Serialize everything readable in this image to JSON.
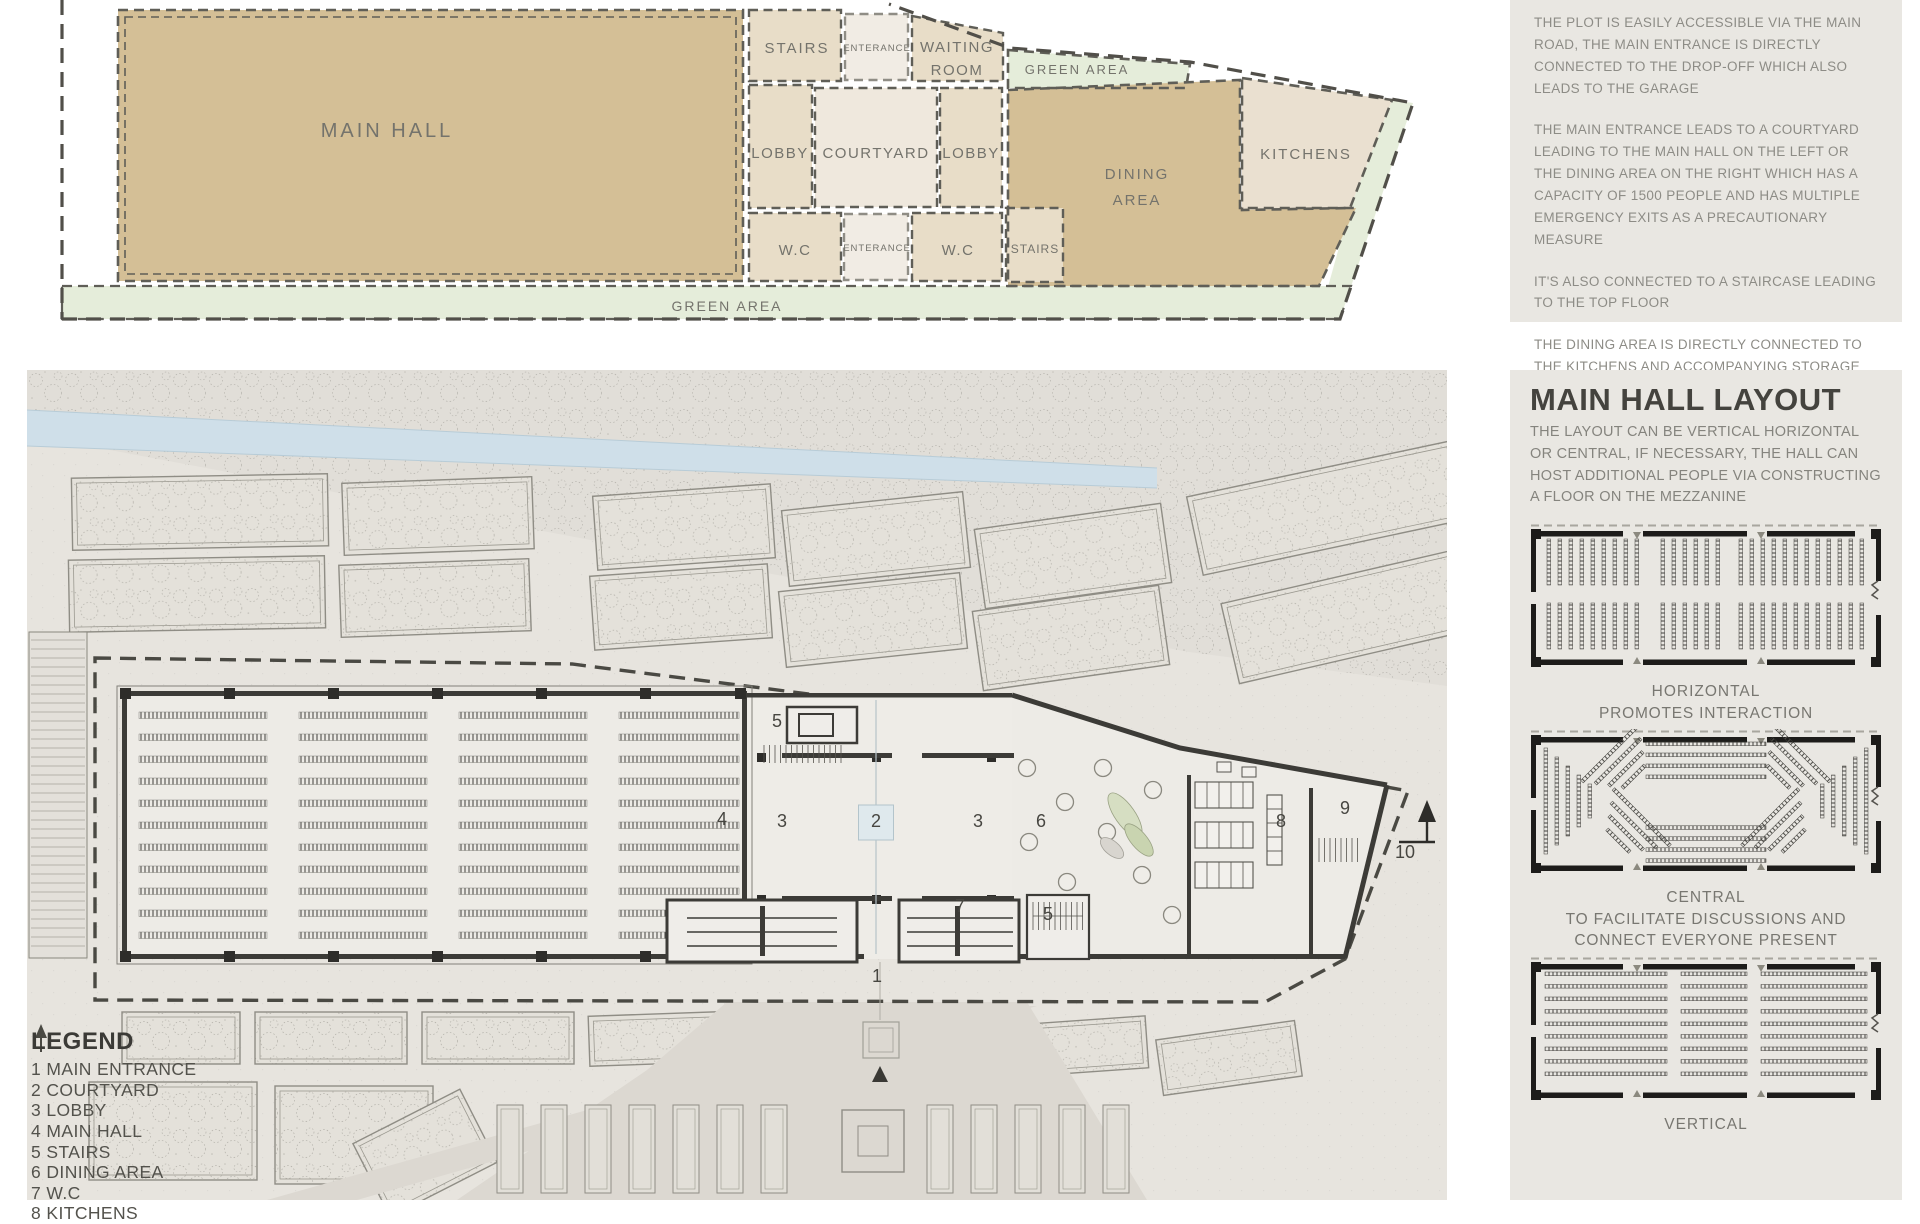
{
  "board": {
    "zoning": {
      "labels": {
        "main_hall": "MAIN HALL",
        "stairs": "STAIRS",
        "enterance": "ENTERANCE",
        "waiting_room": [
          "WAITING",
          "ROOM"
        ],
        "green_area": "GREEN AREA",
        "lobby": "LOBBY",
        "courtyard": "COURTYARD",
        "dining_area": [
          "DINING",
          "AREA"
        ],
        "kitchens": "KITCHENS",
        "wc": "W.C"
      }
    },
    "circulation_notes": {
      "paragraphs": [
        "THE PLOT IS EASILY ACCESSIBLE VIA THE MAIN ROAD, THE MAIN ENTRANCE IS DIRECTLY CONNECTED TO THE DROP-OFF WHICH ALSO LEADS TO THE GARAGE",
        "THE MAIN ENTRANCE LEADS TO A COURTYARD LEADING TO THE MAIN HALL ON THE LEFT OR THE DINING AREA ON THE RIGHT WHICH HAS A CAPACITY OF 1500 PEOPLE AND HAS MULTIPLE EMERGENCY EXITS AS A PRECAUTIONARY MEASURE",
        "IT'S ALSO CONNECTED TO A STAIRCASE LEADING TO THE TOP FLOOR",
        "THE DINING AREA IS DIRECTLY CONNECTED TO THE KITCHENS AND ACCOMPANYING STORAGE ROOMS IN ADDITION TO A STAIRCASE LEADING TO THE DINING AREA ON THE TOP FLOOR"
      ]
    },
    "site_plan": {
      "legend": {
        "title": "LEGEND",
        "items": [
          {
            "num": "1",
            "label": "MAIN ENTRANCE"
          },
          {
            "num": "2",
            "label": "COURTYARD"
          },
          {
            "num": "3",
            "label": "LOBBY"
          },
          {
            "num": "4",
            "label": "MAIN HALL"
          },
          {
            "num": "5",
            "label": "STAIRS"
          },
          {
            "num": "6",
            "label": "DINING AREA"
          },
          {
            "num": "7",
            "label": "W.C"
          },
          {
            "num": "8",
            "label": "KITCHENS"
          }
        ]
      },
      "markers": [
        {
          "label": "5",
          "x": 750,
          "y": 357
        },
        {
          "label": "4",
          "x": 695,
          "y": 455
        },
        {
          "label": "3",
          "x": 755,
          "y": 457
        },
        {
          "label": "2",
          "x": 849,
          "y": 457,
          "boxed": true
        },
        {
          "label": "3",
          "x": 951,
          "y": 457
        },
        {
          "label": "6",
          "x": 1014,
          "y": 457
        },
        {
          "label": "7",
          "x": 933,
          "y": 542
        },
        {
          "label": "5",
          "x": 1021,
          "y": 550
        },
        {
          "label": "1",
          "x": 850,
          "y": 612
        },
        {
          "label": "8",
          "x": 1254,
          "y": 457
        },
        {
          "label": "9",
          "x": 1318,
          "y": 444
        },
        {
          "label": "10",
          "x": 1378,
          "y": 488
        }
      ]
    },
    "main_hall_layout": {
      "title": "MAIN HALL LAYOUT",
      "description": "THE LAYOUT CAN BE VERTICAL HORIZONTAL OR CENTRAL, IF NECESSARY, THE HALL CAN HOST ADDITIONAL PEOPLE VIA CONSTRUCTING A FLOOR ON THE MEZZANINE",
      "options": [
        {
          "name": "HORIZONTAL",
          "caption": "PROMOTES INTERACTION",
          "arrangement": "horizontal"
        },
        {
          "name": "CENTRAL",
          "caption": "TO FACILITATE DISCUSSIONS AND CONNECT EVERYONE PRESENT",
          "arrangement": "central"
        },
        {
          "name": "VERTICAL",
          "caption": "",
          "arrangement": "vertical"
        }
      ]
    },
    "palette": {
      "paper": "#e9e7e2",
      "plan_ground": "#e7e4de",
      "tan_mass": "#d4bf96",
      "room_beige": "#e8ddc8",
      "room_light": "#f1ece4",
      "green_area": "#e5edda",
      "canal_blue": "#cfdfe9",
      "wall_dark": "#3c3b37",
      "dash_gray": "#55544e",
      "text_gray": "#8d8c86",
      "heading_dark": "#44433e",
      "courtyard_blue": "#dfe9ed"
    }
  }
}
